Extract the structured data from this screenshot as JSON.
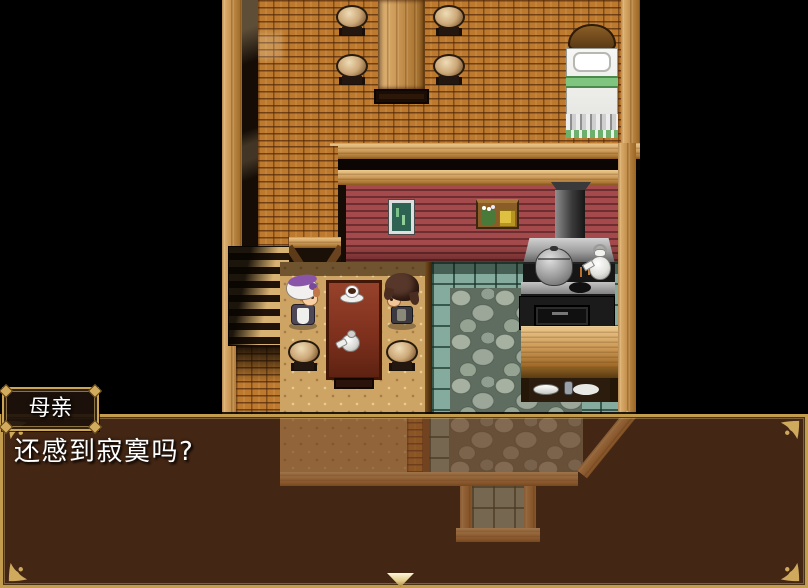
{
  "dialogue": {
    "speaker": "母亲",
    "text": "还感到寂寞吗?"
  },
  "scene": {
    "objects": "bed, stools, pillar, stairs, picture-frame, wall-shelf, stove, kettle, pot, dining-table, teacup, teapot, mother-sprite, boy-sprite, kitchen-counter, plates"
  },
  "colors": {
    "window_tint": "rgba(108,62,33,0.62)",
    "window_border": "#c39c4e",
    "name_box_bg": "rgba(30,18,11,0.93)",
    "text": "#ffffff",
    "cursor": "#f0e2ae"
  }
}
